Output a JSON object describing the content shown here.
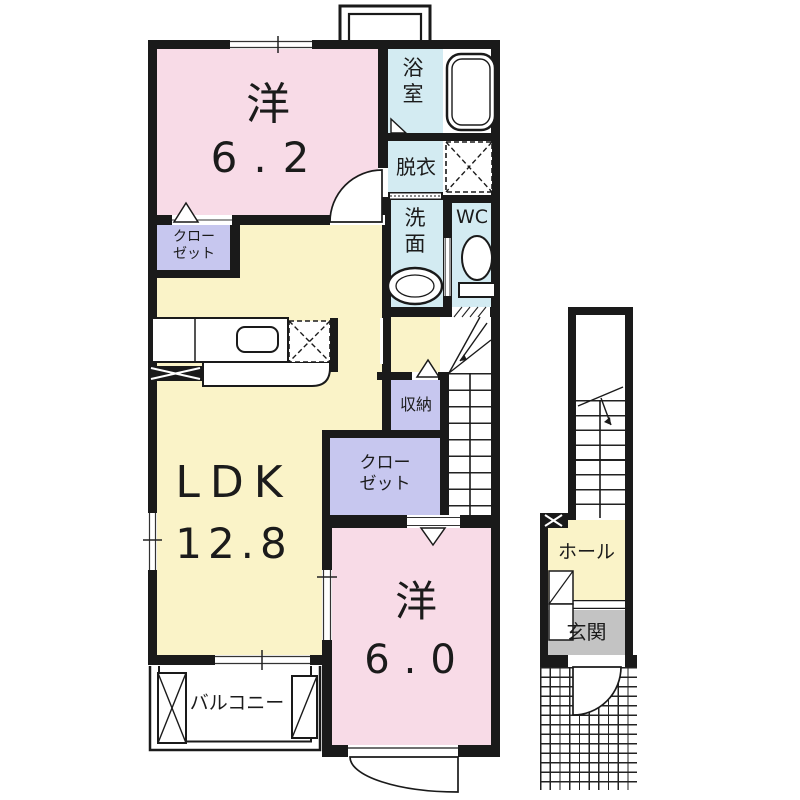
{
  "floor_plan": {
    "floor2": {
      "western_room_62": {
        "label": "洋",
        "area": "6.2"
      },
      "bathroom": {
        "label": "浴室"
      },
      "dressing_room": {
        "label": "脱衣"
      },
      "washroom": {
        "label": "洗面"
      },
      "toilet_room": {
        "label": "WC"
      },
      "closet_upper": {
        "label": "クロー\nゼット"
      },
      "storage": {
        "label": "収納"
      },
      "closet_lower": {
        "label": "クロー\nゼット"
      },
      "ldk": {
        "label": "LDK",
        "area": "12.8"
      },
      "western_room_60": {
        "label": "洋",
        "area": "6.0"
      },
      "balcony": {
        "label": "バルコニー"
      }
    },
    "floor1": {
      "hall": {
        "label": "ホール"
      },
      "entrance": {
        "label": "玄関"
      }
    },
    "colors": {
      "room_pink": "#f8dbe7",
      "room_yellow": "#faf3c8",
      "room_blue": "#d3ebf2",
      "room_purple": "#c7c7ef",
      "room_gray": "#c3c3c3",
      "wall": "#1a1a1a"
    }
  }
}
